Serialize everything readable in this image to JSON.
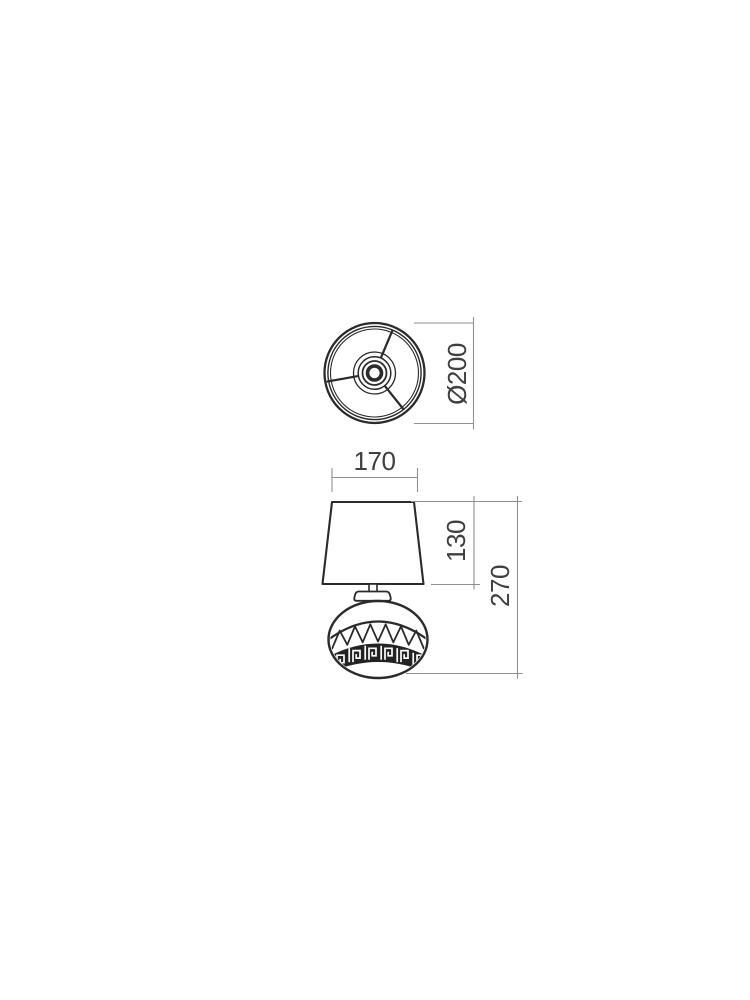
{
  "drawing": {
    "kind": "technical line drawing, table lamp, two orthographic views",
    "dimensions": {
      "shade_top_width": "170",
      "shade_height": "130",
      "total_height": "270",
      "shade_diameter": "Ø200"
    },
    "colors": {
      "outline": "#2b2b2b",
      "dimension_line": "#8f8f8f",
      "dimension_text": "#3f3f3f",
      "background": "#ffffff"
    }
  }
}
